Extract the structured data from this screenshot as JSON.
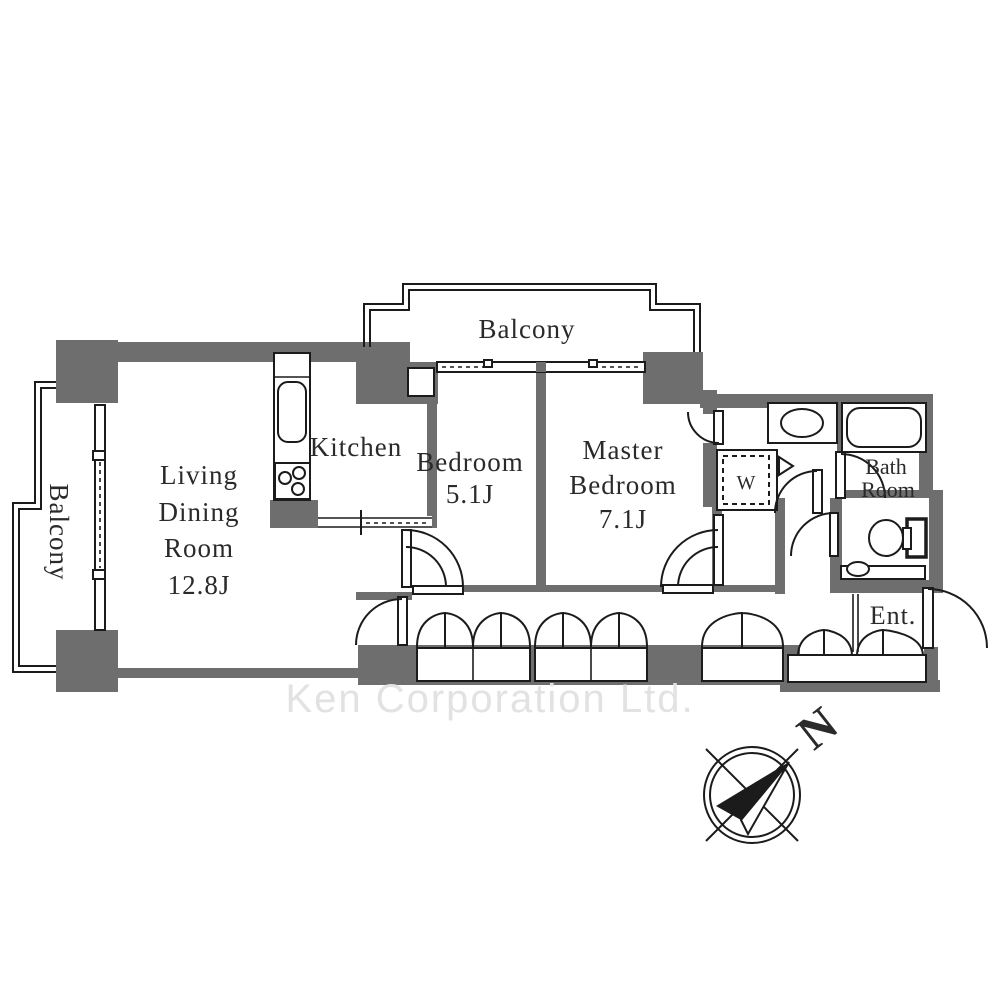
{
  "floorplan": {
    "rooms": {
      "living": {
        "lines": [
          "Living",
          "Dining",
          "Room",
          "12.8J"
        ]
      },
      "kitchen": {
        "label": "Kitchen"
      },
      "bedroom": {
        "lines": [
          "Bedroom",
          "5.1J"
        ]
      },
      "master": {
        "lines": [
          "Master",
          "Bedroom",
          "7.1J"
        ]
      },
      "bath": {
        "lines": [
          "Bath",
          "Room"
        ]
      },
      "entrance": {
        "label": "Ent."
      },
      "laundry": {
        "label": "W"
      },
      "balcony_top": {
        "label": "Balcony"
      },
      "balcony_left": {
        "label": "Balcony"
      }
    },
    "compass": {
      "north_label": "N"
    },
    "watermark": {
      "text": "Ken Corporation Ltd."
    },
    "colors": {
      "wall": "#6e6e6e",
      "line": "#1b1b1b",
      "text": "#2a2a2a",
      "watermark": "#e2e2e2",
      "background": "#ffffff"
    }
  }
}
